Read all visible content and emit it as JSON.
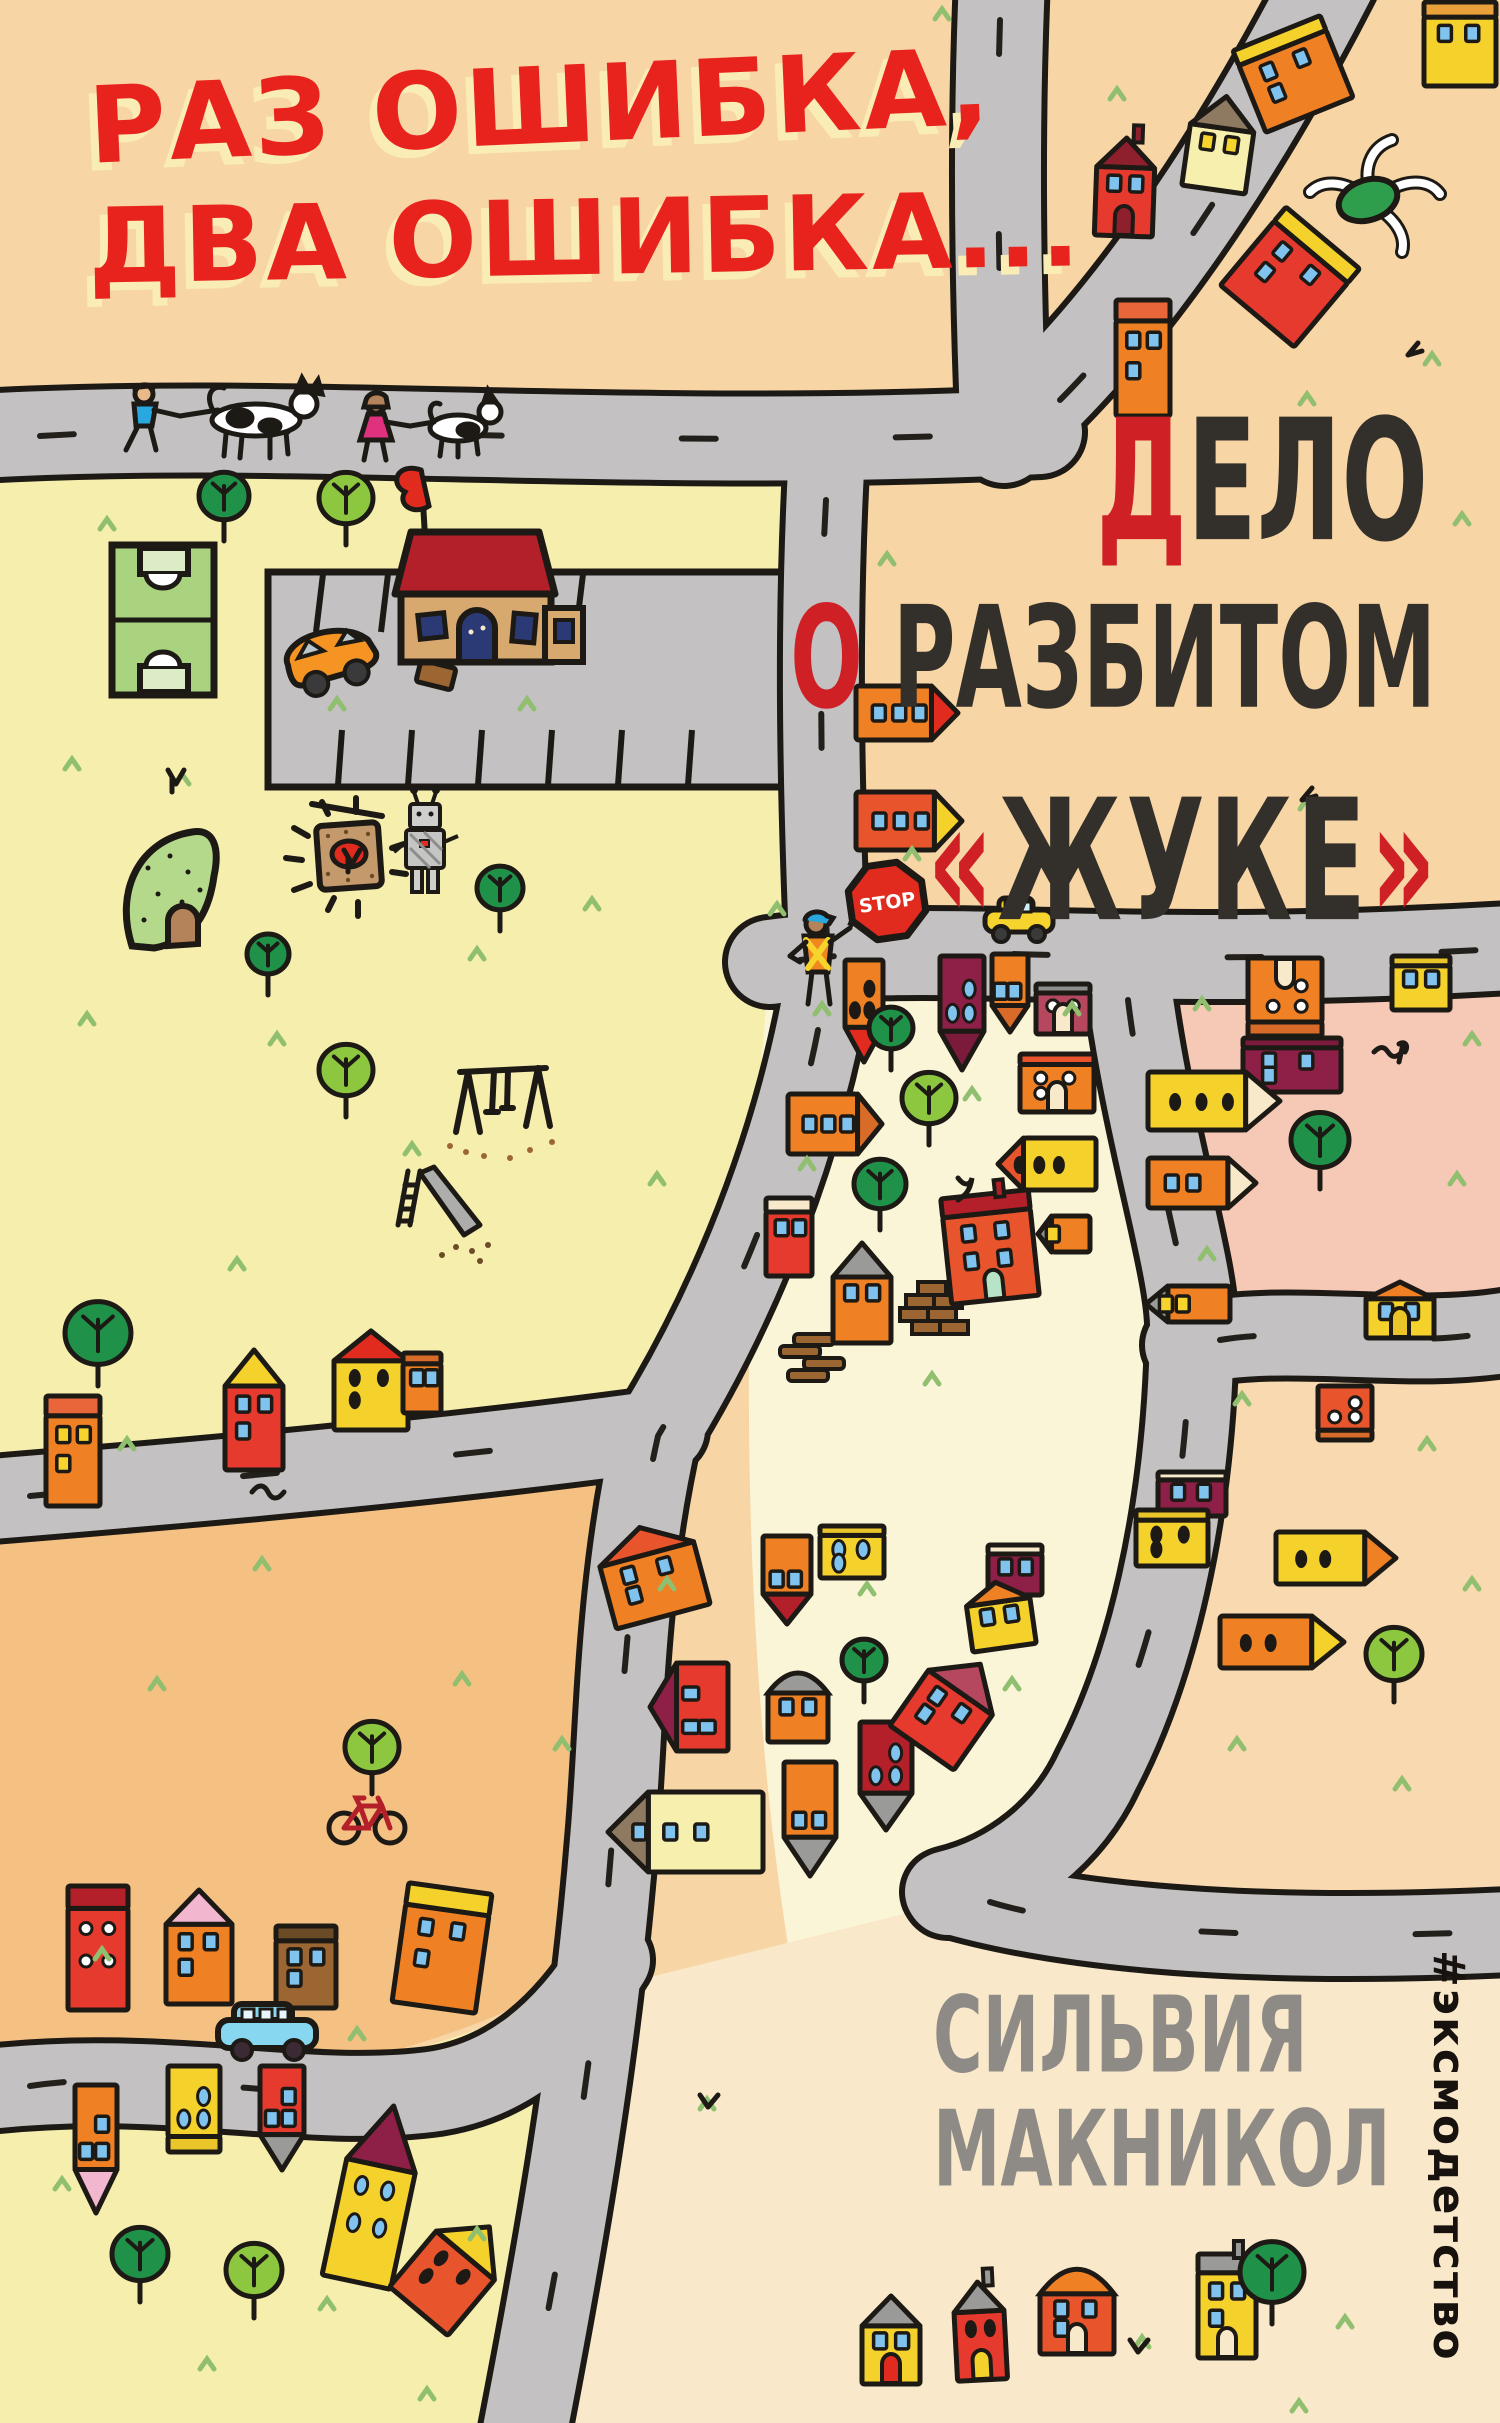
{
  "cover": {
    "title": {
      "line1": "РАЗ ОШИБКА,",
      "line2": "ДВА ОШИБКА..."
    },
    "subtitle": {
      "word1_accent": "Д",
      "word1_rest": "ЕЛО",
      "word2_accent": "О",
      "word2_rest": " РАЗБИТОМ",
      "word3_open": "«",
      "word3": "ЖУКЕ",
      "word3_close": "»"
    },
    "author": {
      "first_name": "СИЛЬВИЯ",
      "last_name": "МАКНИКОЛ"
    },
    "publisher": {
      "hashtag": "#эксмодетство"
    },
    "signs": {
      "stop": "STOP"
    }
  },
  "palette": {
    "top_peach": "#f7d5a5",
    "park_yellow": "#f6eead",
    "block_cream": "#fbf5d8",
    "pink_block": "#f6c8b6",
    "right_peach": "#f8d9b0",
    "orange_block": "#f5c183",
    "bottom_cream": "#f9e8ca",
    "road_gray": "#c3c1c2",
    "outline_ink": "#1d1a16",
    "title_red": "#e8221c",
    "title_shadow_cream": "#f9ecb4",
    "subtitle_dark": "#33302b",
    "accent_red": "#cf2026",
    "author_gray": "#8e8b86",
    "tree_dark_green": "#1f9148",
    "tree_light_green": "#8dc63f",
    "grass_green": "#8fbf6f"
  },
  "scene": {
    "houses": [
      {
        "x": 1424,
        "y": 2,
        "w": 72,
        "h": 84,
        "r": 0,
        "t": "f",
        "b": "#f4d22b",
        "rc": "#e9a13b",
        "wt": "b",
        "wn": 2
      },
      {
        "x": 1246,
        "y": 30,
        "w": 94,
        "h": 88,
        "r": -22,
        "t": "f",
        "b": "#ef8023",
        "rc": "#f4d22b",
        "wt": "b",
        "wn": 3
      },
      {
        "x": 1096,
        "y": 138,
        "w": 58,
        "h": 98,
        "r": 2,
        "t": "g",
        "b": "#e63a2e",
        "rc": "#8e1f2d",
        "wt": "b",
        "wn": 2,
        "c": 1,
        "d": "#8e1f2d"
      },
      {
        "x": 1188,
        "y": 96,
        "w": 64,
        "h": 94,
        "r": 8,
        "t": "p",
        "b": "#f7efae",
        "rc": "#8d7a60",
        "wt": "y",
        "wn": 2
      },
      {
        "x": 1242,
        "y": 226,
        "w": 96,
        "h": 102,
        "r": 40,
        "t": "f",
        "b": "#e63a2e",
        "rc": "#f4d22b",
        "wt": "b",
        "wn": 3
      },
      {
        "x": 1116,
        "y": 300,
        "w": 54,
        "h": 116,
        "r": 0,
        "t": "f",
        "b": "#ef8023",
        "rc": "#e9653a",
        "wt": "b",
        "wn": 3
      },
      {
        "x": 856,
        "y": 686,
        "w": 102,
        "h": 54,
        "r": 0,
        "t": "pr",
        "b": "#ef8023",
        "tc": "#e02b1e",
        "wt": "b",
        "wn": 3
      },
      {
        "x": 856,
        "y": 792,
        "w": 106,
        "h": 58,
        "r": 0,
        "t": "pr",
        "b": "#e8542b",
        "tc": "#f4d22b",
        "wt": "b",
        "wn": 3
      },
      {
        "x": 845,
        "y": 960,
        "w": 38,
        "h": 102,
        "r": 180,
        "t": "p",
        "b": "#ef8023",
        "rc": "#e02b1e",
        "wt": "o",
        "wn": 3
      },
      {
        "x": 940,
        "y": 956,
        "w": 44,
        "h": 114,
        "r": 180,
        "t": "p",
        "b": "#8e1f46",
        "rc": "#7c1a3c",
        "wt": "t",
        "wn": 3
      },
      {
        "x": 992,
        "y": 954,
        "w": 36,
        "h": 78,
        "r": 180,
        "t": "p",
        "b": "#ef8023",
        "rc": "#d96b28",
        "wt": "b",
        "wn": 2
      },
      {
        "x": 1036,
        "y": 984,
        "w": 54,
        "h": 50,
        "r": 0,
        "t": "f",
        "b": "#b5485f",
        "rc": "#8d8d8b",
        "wt": "w",
        "wn": 2,
        "d": "#f7e9c9"
      },
      {
        "x": 1020,
        "y": 1054,
        "w": 74,
        "h": 58,
        "r": 0,
        "t": "f",
        "b": "#ef8023",
        "rc": "#e8542b",
        "wt": "w",
        "wn": 3,
        "d": "#f7e9c9"
      },
      {
        "x": 998,
        "y": 1138,
        "w": 98,
        "h": 52,
        "r": 0,
        "t": "pl",
        "b": "#f4d22b",
        "tc": "#e8542b",
        "wt": "o",
        "wn": 3
      },
      {
        "x": 788,
        "y": 1094,
        "w": 94,
        "h": 60,
        "r": 0,
        "t": "pr",
        "b": "#ef8023",
        "tc": "#d96b28",
        "wt": "b",
        "wn": 3
      },
      {
        "x": 946,
        "y": 1194,
        "w": 88,
        "h": 106,
        "r": -6,
        "t": "f",
        "b": "#e8542b",
        "rc": "#b3202a",
        "wt": "b",
        "wn": 4,
        "c": 1,
        "d": "#b7e3c6"
      },
      {
        "x": 766,
        "y": 1198,
        "w": 46,
        "h": 78,
        "r": 0,
        "t": "f",
        "b": "#e63a2e",
        "rc": "#f7e9c9",
        "wt": "b",
        "wn": 2
      },
      {
        "x": 833,
        "y": 1243,
        "w": 58,
        "h": 100,
        "r": 0,
        "t": "p",
        "b": "#ef8023",
        "rc": "#9a9a98",
        "wt": "b",
        "wn": 2
      },
      {
        "x": 1146,
        "y": 1286,
        "w": 84,
        "h": 36,
        "r": 0,
        "t": "pl",
        "b": "#ef8023",
        "tc": "#9a9a98",
        "wt": "y",
        "wn": 2
      },
      {
        "x": 1038,
        "y": 1216,
        "w": 52,
        "h": 36,
        "r": 0,
        "t": "pl",
        "b": "#ef8023",
        "tc": "#8d8d8b",
        "wt": "y",
        "wn": 1
      },
      {
        "x": 1158,
        "y": 1472,
        "w": 68,
        "h": 44,
        "r": 0,
        "t": "f",
        "b": "#8e1f46",
        "rc": "#f7e9c9",
        "wt": "b",
        "wn": 2
      },
      {
        "x": 1136,
        "y": 1510,
        "w": 72,
        "h": 56,
        "r": 0,
        "t": "f",
        "b": "#f4d22b",
        "rc": "#e9c52a",
        "wt": "o",
        "wn": 3
      },
      {
        "x": 820,
        "y": 1526,
        "w": 64,
        "h": 52,
        "r": 0,
        "t": "f",
        "b": "#f4d22b",
        "rc": "#e9c52a",
        "wt": "t",
        "wn": 3
      },
      {
        "x": 763,
        "y": 1536,
        "w": 48,
        "h": 88,
        "r": 180,
        "t": "p",
        "b": "#ef8023",
        "rc": "#b3202a",
        "wt": "b",
        "wn": 2
      },
      {
        "x": 768,
        "y": 1672,
        "w": 60,
        "h": 70,
        "r": 0,
        "t": "d",
        "b": "#ef8023",
        "rc": "#9a9a98",
        "wt": "b",
        "wn": 2
      },
      {
        "x": 784,
        "y": 1762,
        "w": 52,
        "h": 114,
        "r": 180,
        "t": "p",
        "b": "#ef8023",
        "rc": "#9a9a98",
        "wt": "b",
        "wn": 2
      },
      {
        "x": 860,
        "y": 1722,
        "w": 52,
        "h": 108,
        "r": 180,
        "t": "p",
        "b": "#b3202a",
        "rc": "#9a9a98",
        "wt": "t",
        "wn": 3
      },
      {
        "x": 912,
        "y": 1655,
        "w": 78,
        "h": 102,
        "r": 35,
        "t": "p",
        "b": "#e63a2e",
        "rc": "#b5485f",
        "wt": "b",
        "wn": 3
      },
      {
        "x": 988,
        "y": 1545,
        "w": 54,
        "h": 50,
        "r": 0,
        "t": "f",
        "b": "#8e1f46",
        "rc": "#f7e9c9",
        "wt": "b",
        "wn": 2
      },
      {
        "x": 968,
        "y": 1582,
        "w": 64,
        "h": 66,
        "r": -8,
        "t": "g",
        "b": "#f4d22b",
        "rc": "#ef8023",
        "wt": "b",
        "wn": 2
      },
      {
        "x": 1248,
        "y": 958,
        "w": 74,
        "h": 78,
        "r": 180,
        "t": "f",
        "b": "#ef8023",
        "rc": "#d96b28",
        "wt": "w",
        "wn": 3,
        "d": "#f7e9c9"
      },
      {
        "x": 1392,
        "y": 956,
        "w": 58,
        "h": 54,
        "r": 0,
        "t": "f",
        "b": "#f4d22b",
        "rc": "#e9c52a",
        "wt": "b",
        "wn": 2
      },
      {
        "x": 1243,
        "y": 1038,
        "w": 98,
        "h": 54,
        "r": 0,
        "t": "f",
        "b": "#8e1f46",
        "rc": "#7c1a3c",
        "wt": "b",
        "wn": 3
      },
      {
        "x": 1148,
        "y": 1072,
        "w": 132,
        "h": 58,
        "r": 0,
        "t": "pr",
        "b": "#f4d22b",
        "tc": "#f7e9c9",
        "wt": "o",
        "wn": 3
      },
      {
        "x": 1148,
        "y": 1158,
        "w": 108,
        "h": 50,
        "r": 0,
        "t": "pr",
        "b": "#ef8023",
        "tc": "#f7e9c9",
        "wt": "b",
        "wn": 2
      },
      {
        "x": 1366,
        "y": 1282,
        "w": 68,
        "h": 56,
        "r": 0,
        "t": "g",
        "b": "#f4d22b",
        "rc": "#ef8023",
        "wt": "b",
        "wn": 2,
        "d": "#e9c52a"
      },
      {
        "x": 1318,
        "y": 1386,
        "w": 54,
        "h": 54,
        "r": 180,
        "t": "f",
        "b": "#e8542b",
        "rc": "#d96b28",
        "wt": "w",
        "wn": 3
      },
      {
        "x": 1276,
        "y": 1532,
        "w": 120,
        "h": 52,
        "r": 0,
        "t": "pr",
        "b": "#f4d22b",
        "tc": "#ef8023",
        "wt": "o",
        "wn": 2
      },
      {
        "x": 1220,
        "y": 1616,
        "w": 124,
        "h": 52,
        "r": 0,
        "t": "pr",
        "b": "#ef8023",
        "tc": "#f4d22b",
        "wt": "o",
        "wn": 2
      },
      {
        "x": 225,
        "y": 1350,
        "w": 58,
        "h": 120,
        "r": 0,
        "t": "g",
        "b": "#e63a2e",
        "rc": "#f4d22b",
        "wt": "b",
        "wn": 3
      },
      {
        "x": 334,
        "y": 1331,
        "w": 74,
        "h": 99,
        "r": 0,
        "t": "g",
        "b": "#f4d22b",
        "rc": "#e02b1e",
        "wt": "o",
        "wn": 3
      },
      {
        "x": 403,
        "y": 1353,
        "w": 38,
        "h": 60,
        "r": 0,
        "t": "f",
        "b": "#ef8023",
        "rc": "#d96b28",
        "wt": "b",
        "wn": 2
      },
      {
        "x": 46,
        "y": 1396,
        "w": 54,
        "h": 110,
        "r": 0,
        "t": "f",
        "b": "#ef8023",
        "rc": "#e9653a",
        "wt": "y",
        "wn": 3
      },
      {
        "x": 68,
        "y": 1886,
        "w": 60,
        "h": 124,
        "r": 0,
        "t": "f",
        "b": "#e63a2e",
        "rc": "#b3202a",
        "wt": "w",
        "wn": 4
      },
      {
        "x": 166,
        "y": 1890,
        "w": 66,
        "h": 114,
        "r": 0,
        "t": "g",
        "b": "#ef8023",
        "rc": "#f2b7cf",
        "wt": "b",
        "wn": 3
      },
      {
        "x": 276,
        "y": 1926,
        "w": 60,
        "h": 82,
        "r": 0,
        "t": "f",
        "b": "#9c6632",
        "rc": "#6b4a26",
        "wt": "b",
        "wn": 3
      },
      {
        "x": 400,
        "y": 1888,
        "w": 84,
        "h": 120,
        "r": 8,
        "t": "f",
        "b": "#ef8023",
        "rc": "#f4d22b",
        "wt": "b",
        "wn": 3
      },
      {
        "x": 603,
        "y": 1526,
        "w": 97,
        "h": 92,
        "r": -15,
        "t": "g",
        "b": "#ef8023",
        "rc": "#e8542b",
        "wt": "b",
        "wn": 3
      },
      {
        "x": 645,
        "y": 1668,
        "w": 88,
        "h": 78,
        "r": -90,
        "t": "p",
        "b": "#e63a2e",
        "rc": "#8e1f46",
        "wt": "b",
        "wn": 3
      },
      {
        "x": 608,
        "y": 1792,
        "w": 155,
        "h": 80,
        "r": 0,
        "t": "pl",
        "b": "#f7efae",
        "tc": "#8d7a60",
        "wt": "b",
        "wn": 3
      },
      {
        "x": 75,
        "y": 2085,
        "w": 42,
        "h": 128,
        "r": 180,
        "t": "p",
        "b": "#ef8023",
        "rc": "#f2b7cf",
        "wt": "b",
        "wn": 3
      },
      {
        "x": 168,
        "y": 2066,
        "w": 52,
        "h": 86,
        "r": 180,
        "t": "f",
        "b": "#f4d22b",
        "rc": "#e9c52a",
        "wt": "t",
        "wn": 3
      },
      {
        "x": 260,
        "y": 2066,
        "w": 44,
        "h": 104,
        "r": 180,
        "t": "p",
        "b": "#e63a2e",
        "rc": "#9a9a98",
        "wt": "b",
        "wn": 3
      },
      {
        "x": 340,
        "y": 2104,
        "w": 70,
        "h": 180,
        "r": 12,
        "t": "p",
        "b": "#f4d22b",
        "rc": "#8e1f46",
        "wt": "t",
        "wn": 4
      },
      {
        "x": 416,
        "y": 2214,
        "w": 76,
        "h": 110,
        "r": 40,
        "t": "p",
        "b": "#e8542b",
        "rc": "#f4d22b",
        "wt": "o",
        "wn": 3
      },
      {
        "x": 862,
        "y": 2296,
        "w": 58,
        "h": 88,
        "r": 0,
        "t": "p",
        "b": "#f4d22b",
        "rc": "#9a9a98",
        "wt": "b",
        "wn": 2,
        "d": "#e02b1e"
      },
      {
        "x": 955,
        "y": 2282,
        "w": 50,
        "h": 98,
        "r": -3,
        "t": "g",
        "b": "#e63a2e",
        "rc": "#9a9a98",
        "wt": "o",
        "wn": 2,
        "c": 1,
        "d": "#f4d22b"
      },
      {
        "x": 1040,
        "y": 2268,
        "w": 74,
        "h": 86,
        "r": 0,
        "t": "d",
        "b": "#e8542b",
        "rc": "#ef8023",
        "wt": "b",
        "wn": 3,
        "d": "#f7e9c9"
      },
      {
        "x": 1198,
        "y": 2254,
        "w": 58,
        "h": 104,
        "r": 0,
        "t": "f",
        "b": "#f4d22b",
        "rc": "#9a9a98",
        "wt": "b",
        "wn": 3,
        "c": 1,
        "d": "#f7e9c9"
      }
    ],
    "trees": [
      {
        "x": 224,
        "y": 496,
        "r": 25,
        "s": "d"
      },
      {
        "x": 346,
        "y": 498,
        "r": 27,
        "s": "l"
      },
      {
        "x": 500,
        "y": 888,
        "r": 23,
        "s": "d"
      },
      {
        "x": 268,
        "y": 954,
        "r": 21,
        "s": "d"
      },
      {
        "x": 346,
        "y": 1070,
        "r": 27,
        "s": "l"
      },
      {
        "x": 98,
        "y": 1333,
        "r": 33,
        "s": "d"
      },
      {
        "x": 891,
        "y": 1028,
        "r": 22,
        "s": "d"
      },
      {
        "x": 929,
        "y": 1098,
        "r": 27,
        "s": "l"
      },
      {
        "x": 880,
        "y": 1184,
        "r": 26,
        "s": "d"
      },
      {
        "x": 864,
        "y": 1660,
        "r": 22,
        "s": "d"
      },
      {
        "x": 1320,
        "y": 1140,
        "r": 29,
        "s": "d"
      },
      {
        "x": 1394,
        "y": 1654,
        "r": 28,
        "s": "l"
      },
      {
        "x": 372,
        "y": 1747,
        "r": 27,
        "s": "l"
      },
      {
        "x": 140,
        "y": 2254,
        "r": 28,
        "s": "d"
      },
      {
        "x": 254,
        "y": 2270,
        "r": 28,
        "s": "l"
      },
      {
        "x": 1272,
        "y": 2272,
        "r": 32,
        "s": "d"
      }
    ],
    "grass": [
      [
        100,
        520
      ],
      [
        330,
        700
      ],
      [
        65,
        760
      ],
      [
        175,
        775
      ],
      [
        520,
        700
      ],
      [
        270,
        1035
      ],
      [
        80,
        1015
      ],
      [
        585,
        900
      ],
      [
        470,
        950
      ],
      [
        650,
        1175
      ],
      [
        120,
        1440
      ],
      [
        405,
        1145
      ],
      [
        230,
        1260
      ],
      [
        935,
        10
      ],
      [
        1110,
        90
      ],
      [
        1425,
        355
      ],
      [
        1300,
        395
      ],
      [
        1455,
        515
      ],
      [
        880,
        555
      ],
      [
        905,
        850
      ],
      [
        770,
        905
      ],
      [
        815,
        1005
      ],
      [
        965,
        1090
      ],
      [
        1065,
        1005
      ],
      [
        800,
        1160
      ],
      [
        925,
        1375
      ],
      [
        860,
        1585
      ],
      [
        1005,
        1680
      ],
      [
        1195,
        1000
      ],
      [
        1465,
        1035
      ],
      [
        1450,
        1175
      ],
      [
        1200,
        1250
      ],
      [
        1235,
        1395
      ],
      [
        1420,
        1440
      ],
      [
        1465,
        1580
      ],
      [
        1230,
        1740
      ],
      [
        1395,
        1780
      ],
      [
        255,
        1560
      ],
      [
        455,
        1675
      ],
      [
        555,
        1740
      ],
      [
        150,
        1680
      ],
      [
        95,
        1950
      ],
      [
        350,
        2030
      ],
      [
        55,
        2180
      ],
      [
        200,
        2360
      ],
      [
        320,
        2300
      ],
      [
        470,
        2230
      ],
      [
        420,
        2390
      ],
      [
        1135,
        2338
      ],
      [
        1338,
        2318
      ],
      [
        1292,
        2402
      ],
      [
        700,
        2100
      ],
      [
        1300,
        800
      ],
      [
        660,
        1580
      ]
    ]
  }
}
